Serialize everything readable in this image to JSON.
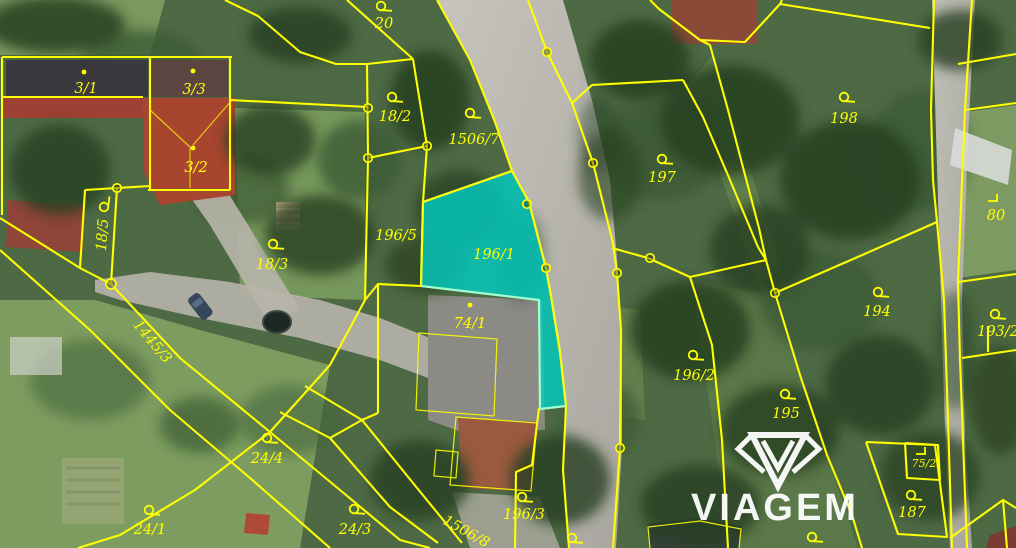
{
  "map": {
    "kind": "cadastral-parcel-map-over-aerial-photo",
    "watermark": {
      "brand": "VIAGEM"
    },
    "highlighted_parcel": {
      "number": "196/1"
    },
    "colors": {
      "boundary_line": "#ffff00",
      "label_text": "#ffff00",
      "highlight_fill": "#00cfc5",
      "highlight_stroke": "#a0ffcf",
      "watermark": "#ffffff",
      "road": "#b9b7ae",
      "trees_dark": "#26401f",
      "grass": "#7f9e63"
    },
    "labels": [
      {
        "t": "20",
        "x": 384,
        "y": 24,
        "sym": "loop",
        "sx": 381,
        "sy": 6
      },
      {
        "t": "3/1",
        "x": 86,
        "y": 89,
        "sym": "dot",
        "sx": 84,
        "sy": 72
      },
      {
        "t": "3/3",
        "x": 194,
        "y": 90,
        "sym": "dot",
        "sx": 193,
        "sy": 71
      },
      {
        "t": "3/2",
        "x": 196,
        "y": 168,
        "sym": "dot",
        "sx": 193,
        "sy": 148
      },
      {
        "t": "18/2",
        "x": 395,
        "y": 117,
        "sym": "loop",
        "sx": 392,
        "sy": 97
      },
      {
        "t": "1506/7",
        "x": 474,
        "y": 140,
        "sym": "loop",
        "sx": 470,
        "sy": 113
      },
      {
        "t": "197",
        "x": 662,
        "y": 178,
        "sym": "loop",
        "sx": 662,
        "sy": 159
      },
      {
        "t": "198",
        "x": 844,
        "y": 119,
        "sym": "loop",
        "sx": 844,
        "sy": 97
      },
      {
        "t": "80",
        "x": 996,
        "y": 216,
        "sym": "corner",
        "sx": 993,
        "sy": 199
      },
      {
        "t": "18/5",
        "x": 103,
        "y": 235,
        "rot": -86,
        "sym": "loop",
        "sx": 104,
        "sy": 207,
        "srot": -86
      },
      {
        "t": "18/3",
        "x": 272,
        "y": 265,
        "sym": "loop",
        "sx": 273,
        "sy": 244
      },
      {
        "t": "196/5",
        "x": 396,
        "y": 236
      },
      {
        "t": "196/1",
        "x": 494,
        "y": 255
      },
      {
        "t": "74/1",
        "x": 470,
        "y": 324,
        "sym": "dot",
        "sx": 470,
        "sy": 305
      },
      {
        "t": "196/2",
        "x": 694,
        "y": 376,
        "sym": "loop",
        "sx": 693,
        "sy": 355
      },
      {
        "t": "195",
        "x": 786,
        "y": 414,
        "sym": "loop",
        "sx": 785,
        "sy": 394
      },
      {
        "t": "194",
        "x": 877,
        "y": 312,
        "sym": "loop",
        "sx": 878,
        "sy": 292
      },
      {
        "t": "193/2",
        "x": 998,
        "y": 332,
        "sym": "loop",
        "sx": 995,
        "sy": 314
      },
      {
        "t": "1445/3",
        "x": 152,
        "y": 342,
        "rot": 50
      },
      {
        "t": "24/4",
        "x": 267,
        "y": 459,
        "sym": "loop",
        "sx": 267,
        "sy": 438
      },
      {
        "t": "24/1",
        "x": 150,
        "y": 530,
        "sym": "loop",
        "sx": 149,
        "sy": 510
      },
      {
        "t": "24/3",
        "x": 355,
        "y": 530,
        "sym": "loop",
        "sx": 354,
        "sy": 509
      },
      {
        "t": "1506/8",
        "x": 466,
        "y": 532,
        "rot": 29
      },
      {
        "t": "196/3",
        "x": 524,
        "y": 515,
        "sym": "loop",
        "sx": 522,
        "sy": 497
      },
      {
        "t": "75/2",
        "x": 924,
        "y": 464,
        "size": 11,
        "sym": "corner",
        "sx": 921,
        "sy": 452
      },
      {
        "t": "187",
        "x": 912,
        "y": 513,
        "sym": "loop",
        "sx": 911,
        "sy": 495
      },
      {
        "t": "",
        "x": 812,
        "y": 540,
        "sym": "loop",
        "sx": 812,
        "sy": 537
      },
      {
        "t": "",
        "x": 573,
        "y": 542,
        "sym": "loop",
        "sx": 572,
        "sy": 538
      }
    ]
  }
}
